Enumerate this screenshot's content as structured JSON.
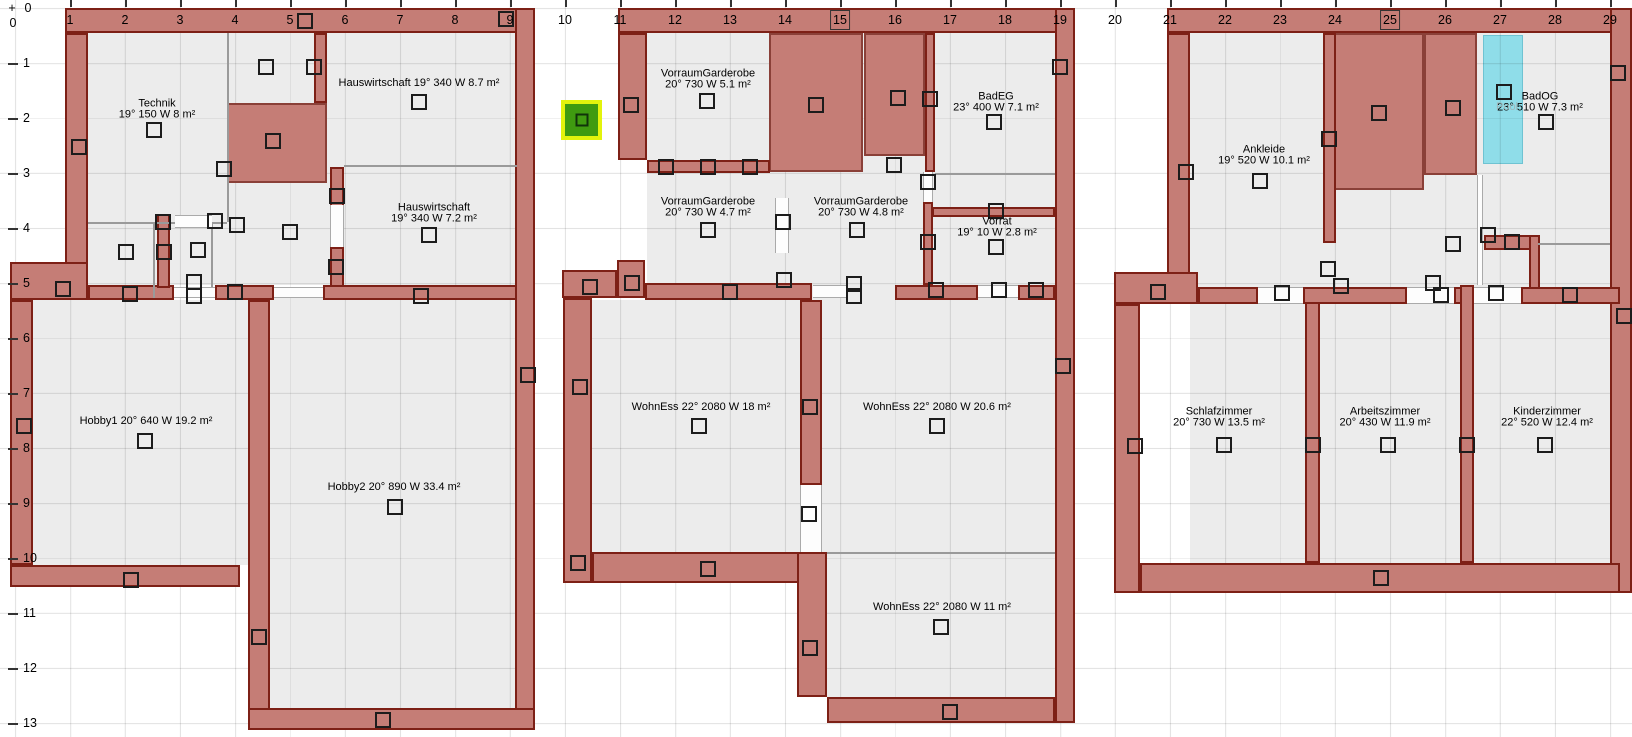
{
  "app": {
    "description_title": "Heating floor plan view"
  },
  "colors": {
    "wall_fill": "#c57d76",
    "wall_border": "#7d2016",
    "floor": "#ececec",
    "selected_ring": "#e2f30c",
    "selected_fill": "#3f9b10",
    "pool_cyan": "#8fdde9",
    "grid_line": "#e2e2e2",
    "partition": "#9a9a9a"
  },
  "ruler": {
    "corner_plus": "+",
    "corner_zero_h": "0",
    "corner_zero_v": "0",
    "h_numbers": [
      "1",
      "2",
      "3",
      "4",
      "5",
      "6",
      "7",
      "8",
      "9",
      "10",
      "11",
      "12",
      "13",
      "14",
      "15",
      "16",
      "17",
      "18",
      "19",
      "20",
      "21",
      "22",
      "23",
      "24",
      "25",
      "26",
      "27",
      "28",
      "29"
    ],
    "v_numbers": [
      "1",
      "2",
      "3",
      "4",
      "5",
      "6",
      "7",
      "8",
      "9",
      "10",
      "11",
      "12",
      "13"
    ],
    "boxed_h": [
      "15",
      "25"
    ],
    "origin_x": 15,
    "origin_y": 8,
    "step": 55
  },
  "plans": [
    {
      "name": "plan-basement",
      "floors": [
        [
          88,
          33,
          427,
          252
        ],
        [
          33,
          300,
          215,
          265
        ],
        [
          270,
          298,
          245,
          410
        ]
      ],
      "stairs": [
        [
          227,
          103,
          100,
          80
        ]
      ],
      "walls": [
        [
          65,
          8,
          470,
          25
        ],
        [
          515,
          8,
          20,
          722
        ],
        [
          65,
          33,
          23,
          252
        ],
        [
          10,
          262,
          78,
          38
        ],
        [
          10,
          300,
          23,
          265
        ],
        [
          10,
          565,
          230,
          22
        ],
        [
          248,
          300,
          22,
          430
        ],
        [
          248,
          708,
          287,
          22
        ],
        [
          314,
          33,
          13,
          70
        ],
        [
          330,
          167,
          14,
          45
        ],
        [
          330,
          247,
          14,
          51
        ],
        [
          88,
          285,
          86,
          15
        ],
        [
          215,
          285,
          59,
          15
        ],
        [
          323,
          285,
          194,
          15
        ],
        [
          157,
          214,
          13,
          74
        ]
      ],
      "partitions": [
        [
          227,
          33,
          2,
          189
        ],
        [
          88,
          222,
          139,
          2
        ],
        [
          344,
          165,
          173,
          2
        ],
        [
          153,
          222,
          2,
          76
        ],
        [
          211,
          222,
          2,
          76
        ]
      ],
      "doors": [
        [
          174,
          287,
          41,
          11,
          "h"
        ],
        [
          274,
          287,
          49,
          11,
          "h"
        ],
        [
          330,
          205,
          14,
          42,
          "v"
        ],
        [
          175,
          215,
          37,
          13,
          "h"
        ]
      ],
      "rooms": [
        {
          "line1": "Technik",
          "line2": "19° 150 W 8 m²",
          "x": 157,
          "y": 109
        },
        {
          "line1": "Hauswirtschaft 19° 340 W 8.7 m²",
          "line2": "",
          "x": 419,
          "y": 83
        },
        {
          "line1": "Hauswirtschaft",
          "line2": "19° 340 W 7.2 m²",
          "x": 434,
          "y": 213
        },
        {
          "line1": "Hobby1 20° 640 W 19.2 m²",
          "line2": "",
          "x": 146,
          "y": 421
        },
        {
          "line1": "Hobby2 20° 890 W 33.4 m²",
          "line2": "",
          "x": 394,
          "y": 487
        }
      ]
    },
    {
      "name": "plan-ground-floor",
      "floors": [
        [
          647,
          33,
          408,
          267
        ],
        [
          592,
          300,
          210,
          252
        ],
        [
          822,
          300,
          233,
          252
        ],
        [
          827,
          552,
          228,
          145
        ]
      ],
      "stairs": [
        [
          769,
          33,
          94,
          139
        ],
        [
          864,
          33,
          61,
          123
        ]
      ],
      "walls": [
        [
          618,
          8,
          457,
          25
        ],
        [
          1055,
          8,
          20,
          715
        ],
        [
          618,
          33,
          29,
          127
        ],
        [
          925,
          33,
          10,
          139
        ],
        [
          923,
          202,
          10,
          83
        ],
        [
          932,
          207,
          123,
          10
        ],
        [
          647,
          160,
          123,
          13
        ],
        [
          562,
          270,
          55,
          28
        ],
        [
          617,
          260,
          28,
          38
        ],
        [
          645,
          283,
          167,
          17
        ],
        [
          895,
          285,
          83,
          15
        ],
        [
          1018,
          285,
          37,
          15
        ],
        [
          563,
          298,
          29,
          285
        ],
        [
          592,
          552,
          235,
          31
        ],
        [
          800,
          300,
          22,
          185
        ],
        [
          797,
          552,
          30,
          145
        ],
        [
          827,
          697,
          228,
          26
        ]
      ],
      "partitions": [
        [
          935,
          173,
          120,
          2
        ],
        [
          827,
          552,
          228,
          2
        ]
      ],
      "doors": [
        [
          813,
          285,
          34,
          13,
          "h"
        ],
        [
          978,
          285,
          40,
          13,
          "h"
        ],
        [
          775,
          198,
          14,
          55,
          "v"
        ],
        [
          800,
          485,
          22,
          67,
          "v"
        ],
        [
          923,
          172,
          10,
          30,
          "v"
        ]
      ],
      "rooms": [
        {
          "line1": "VorraumGarderobe",
          "line2": "20° 730 W 5.1 m²",
          "x": 708,
          "y": 79
        },
        {
          "line1": "BadEG",
          "line2": "23° 400 W 7.1 m²",
          "x": 996,
          "y": 102
        },
        {
          "line1": "VorraumGarderobe",
          "line2": "20° 730 W 4.7 m²",
          "x": 708,
          "y": 207
        },
        {
          "line1": "VorraumGarderobe",
          "line2": "20° 730 W 4.8 m²",
          "x": 861,
          "y": 207
        },
        {
          "line1": "Vorrat",
          "line2": "19° 10 W 2.8 m²",
          "x": 997,
          "y": 227
        },
        {
          "line1": "WohnEss 22° 2080 W 18 m²",
          "line2": "",
          "x": 701,
          "y": 407
        },
        {
          "line1": "WohnEss 22° 2080 W 20.6 m²",
          "line2": "",
          "x": 937,
          "y": 407
        },
        {
          "line1": "WohnEss 22° 2080 W 11 m²",
          "line2": "",
          "x": 942,
          "y": 607
        }
      ]
    },
    {
      "name": "plan-upper-floor",
      "floors": [
        [
          1190,
          33,
          420,
          530
        ]
      ],
      "stairs": [
        [
          1333,
          33,
          91,
          157
        ],
        [
          1424,
          33,
          53,
          142
        ]
      ],
      "walls": [
        [
          1167,
          8,
          465,
          25
        ],
        [
          1610,
          8,
          22,
          585
        ],
        [
          1167,
          33,
          23,
          252
        ],
        [
          1114,
          272,
          84,
          32
        ],
        [
          1114,
          304,
          26,
          289
        ],
        [
          1140,
          563,
          480,
          30
        ],
        [
          1323,
          33,
          13,
          210
        ],
        [
          1484,
          235,
          54,
          15
        ],
        [
          1529,
          235,
          11,
          69
        ],
        [
          1198,
          287,
          60,
          17
        ],
        [
          1303,
          287,
          104,
          17
        ],
        [
          1454,
          287,
          20,
          17
        ],
        [
          1521,
          287,
          99,
          17
        ],
        [
          1305,
          302,
          15,
          261
        ],
        [
          1460,
          285,
          14,
          278
        ]
      ],
      "partitions": [
        [
          1538,
          243,
          72,
          2
        ]
      ],
      "doors": [
        [
          1477,
          175,
          6,
          110,
          "v"
        ],
        [
          1258,
          287,
          45,
          17,
          "h"
        ],
        [
          1407,
          287,
          47,
          17,
          "h"
        ],
        [
          1474,
          287,
          47,
          17,
          "h"
        ]
      ],
      "rooms": [
        {
          "line1": "Ankleide",
          "line2": "19° 520 W 10.1 m²",
          "x": 1264,
          "y": 155
        },
        {
          "line1": "BadOG",
          "line2": "23° 510 W 7.3 m²",
          "x": 1540,
          "y": 102
        },
        {
          "line1": "Schlafzimmer",
          "line2": "20° 730 W 13.5 m²",
          "x": 1219,
          "y": 417
        },
        {
          "line1": "Arbeitszimmer",
          "line2": "20° 430 W 11.9 m²",
          "x": 1385,
          "y": 417
        },
        {
          "line1": "Kinderzimmer",
          "line2": "22° 520 W 12.4 m²",
          "x": 1547,
          "y": 417
        }
      ]
    }
  ],
  "ghost_label": {
    "text": "Pool",
    "x": 1507,
    "y": 107
  },
  "cyan_area": {
    "x": 1483,
    "y": 35,
    "w": 40,
    "h": 129
  },
  "green_marker": {
    "x": 561,
    "y": 100,
    "w": 41,
    "h": 40
  },
  "symbols": [
    [
      305,
      21
    ],
    [
      506,
      19
    ],
    [
      266,
      67
    ],
    [
      314,
      67
    ],
    [
      79,
      147
    ],
    [
      154,
      130
    ],
    [
      419,
      102
    ],
    [
      273,
      141
    ],
    [
      224,
      169
    ],
    [
      337,
      196
    ],
    [
      163,
      222
    ],
    [
      215,
      221
    ],
    [
      237,
      225
    ],
    [
      290,
      232
    ],
    [
      429,
      235
    ],
    [
      126,
      252
    ],
    [
      164,
      252
    ],
    [
      198,
      250
    ],
    [
      336,
      267
    ],
    [
      63,
      289
    ],
    [
      130,
      294
    ],
    [
      194,
      282
    ],
    [
      194,
      296
    ],
    [
      235,
      292
    ],
    [
      421,
      296
    ],
    [
      528,
      375
    ],
    [
      24,
      426
    ],
    [
      145,
      441
    ],
    [
      395,
      507
    ],
    [
      131,
      580
    ],
    [
      259,
      637
    ],
    [
      383,
      720
    ],
    [
      631,
      105
    ],
    [
      707,
      101
    ],
    [
      816,
      105
    ],
    [
      898,
      98
    ],
    [
      930,
      99
    ],
    [
      994,
      122
    ],
    [
      1060,
      67
    ],
    [
      666,
      167
    ],
    [
      708,
      167
    ],
    [
      750,
      167
    ],
    [
      894,
      165
    ],
    [
      928,
      182
    ],
    [
      708,
      230
    ],
    [
      783,
      222
    ],
    [
      857,
      230
    ],
    [
      928,
      242
    ],
    [
      996,
      211
    ],
    [
      996,
      247
    ],
    [
      590,
      287
    ],
    [
      632,
      283
    ],
    [
      730,
      292
    ],
    [
      784,
      280
    ],
    [
      854,
      284
    ],
    [
      854,
      296
    ],
    [
      936,
      290
    ],
    [
      999,
      290
    ],
    [
      1036,
      290
    ],
    [
      580,
      387
    ],
    [
      699,
      426
    ],
    [
      810,
      407
    ],
    [
      937,
      426
    ],
    [
      1063,
      366
    ],
    [
      809,
      514
    ],
    [
      578,
      563
    ],
    [
      708,
      569
    ],
    [
      810,
      648
    ],
    [
      941,
      627
    ],
    [
      950,
      712
    ],
    [
      1186,
      172
    ],
    [
      1260,
      181
    ],
    [
      1329,
      139
    ],
    [
      1379,
      113
    ],
    [
      1453,
      108
    ],
    [
      1504,
      92
    ],
    [
      1546,
      122
    ],
    [
      1618,
      73
    ],
    [
      1453,
      244
    ],
    [
      1488,
      235
    ],
    [
      1512,
      242
    ],
    [
      1328,
      269
    ],
    [
      1341,
      286
    ],
    [
      1282,
      293
    ],
    [
      1433,
      283
    ],
    [
      1441,
      295
    ],
    [
      1496,
      293
    ],
    [
      1570,
      295
    ],
    [
      1158,
      292
    ],
    [
      1135,
      446
    ],
    [
      1224,
      445
    ],
    [
      1313,
      445
    ],
    [
      1388,
      445
    ],
    [
      1467,
      445
    ],
    [
      1545,
      445
    ],
    [
      1624,
      316
    ],
    [
      1381,
      578
    ]
  ]
}
